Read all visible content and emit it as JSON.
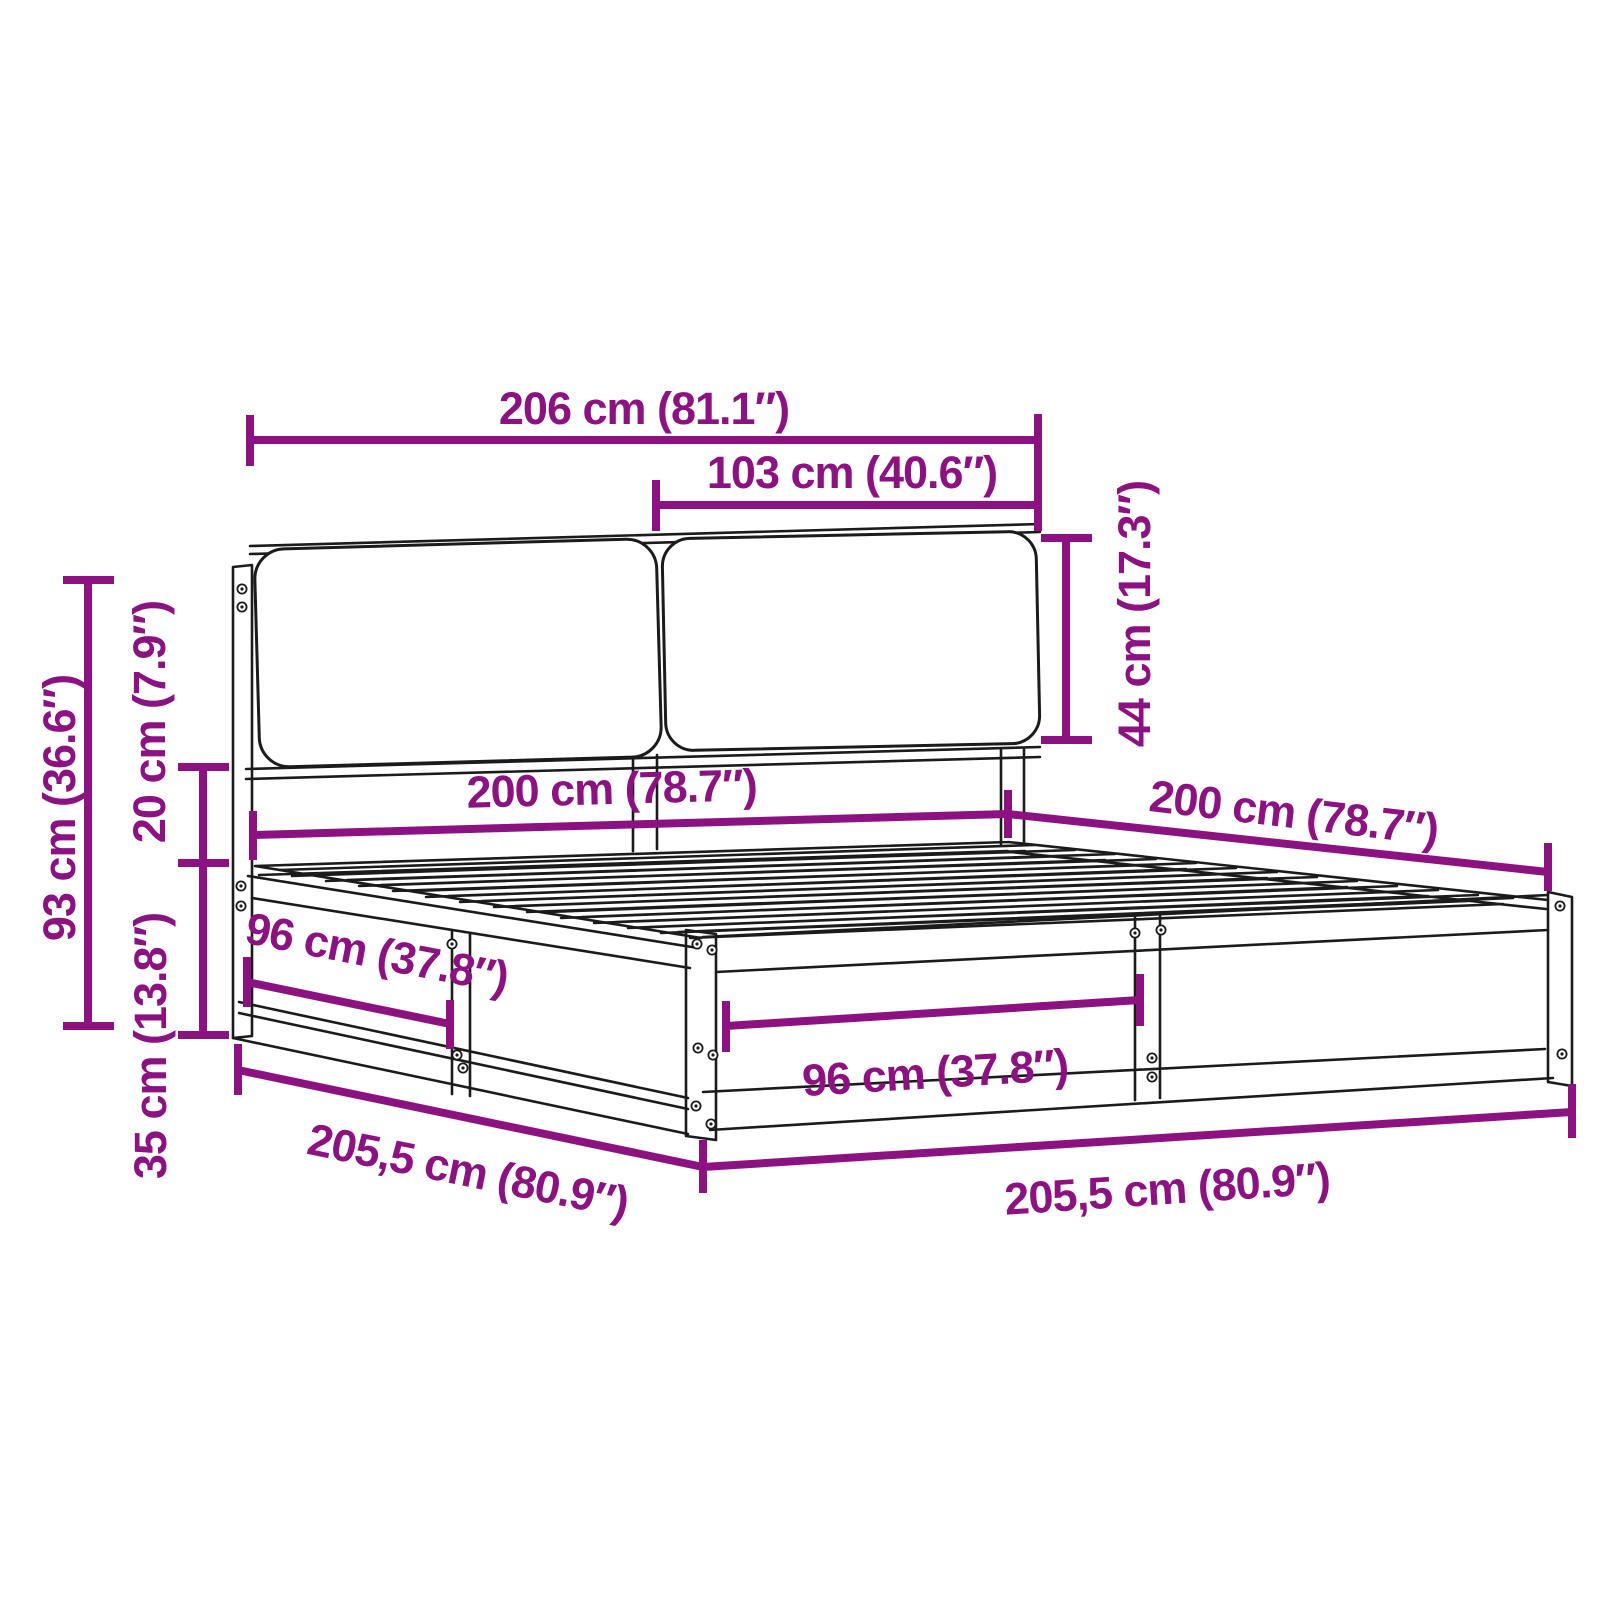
{
  "title": "Bed frame with headboard cushions - dimension diagram",
  "colors": {
    "dimension": "#8B1280",
    "outline": "#1B1B1B",
    "background": "#FFFFFF"
  },
  "dims": {
    "overall_width": "206 cm (81.1″)",
    "headboard_cushion_width": "103 cm (40.6″)",
    "cushion_height": "44 cm (17.3″)",
    "total_height": "93 cm (36.6″)",
    "headboard_gap_height": "20 cm (7.9″)",
    "base_height": "35 cm (13.8″)",
    "bed_width": "200 cm (78.7″)",
    "bed_length": "200 cm (78.7″)",
    "side_panel_half": "96 cm (37.8″)",
    "front_panel_half": "96 cm (37.8″)",
    "side_length": "205,5 cm (80.9″)",
    "front_length": "205,5 cm (80.9″)"
  }
}
